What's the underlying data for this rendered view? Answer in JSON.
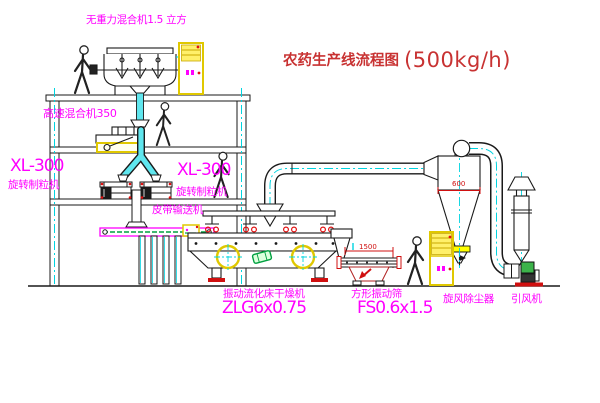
{
  "title": {
    "text": "农药生产线流程图",
    "capacity": "(500kg/h)"
  },
  "equipment_labels": {
    "gravity_mixer": "无重力混合机1.5 立方",
    "high_speed_mixer": "高速混合机350",
    "granulator_left": {
      "model": "XL-300",
      "name": "旋转制粒机"
    },
    "granulator_right": {
      "model": "XL-300",
      "name": "旋转制粒机"
    },
    "belt_conveyor": "皮带输送机",
    "fluid_bed_dryer": {
      "name": "振动流化床干燥机",
      "model": "ZLG6x0.75"
    },
    "square_sieve": {
      "name": "方形振动筛",
      "model": "FS0.6x1.5"
    },
    "cyclone": "旋风除尘器",
    "induced_draft_fan": "引风机"
  },
  "dimensions": {
    "cyclone_diameter": "600",
    "sieve_length": "1500"
  },
  "colors": {
    "label_magenta": "#FF00FF",
    "title_red": "#C83232",
    "centerline_cyan": "#00D4E0",
    "highlight_yellow": "#FFFF4D",
    "accent_red": "#E01010",
    "accent_green": "#00A040",
    "line_black": "#1A1A1A",
    "background": "#FFFFFF"
  }
}
